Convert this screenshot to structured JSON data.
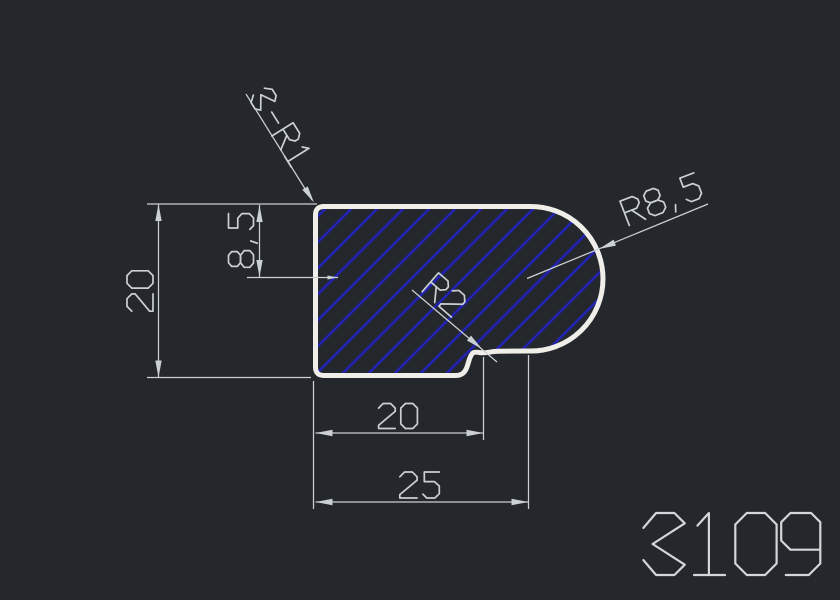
{
  "drawing": {
    "type": "cad-profile-section",
    "background": "#24272c",
    "colors": {
      "outline": "#efeee9",
      "hatch": "#2223b2",
      "dimension": "#cbd0d2",
      "part_number": "#d4d6d7"
    },
    "part_number": "3109",
    "dimensions": {
      "height": {
        "label": "20"
      },
      "arc_center_height": {
        "label": "8,5"
      },
      "corner_radius": {
        "label": "3-R1"
      },
      "main_radius": {
        "label": "R8,5"
      },
      "notch_radius": {
        "label": "R2"
      },
      "width_to_notch": {
        "label": "20"
      },
      "overall_width": {
        "label": "25"
      }
    }
  }
}
